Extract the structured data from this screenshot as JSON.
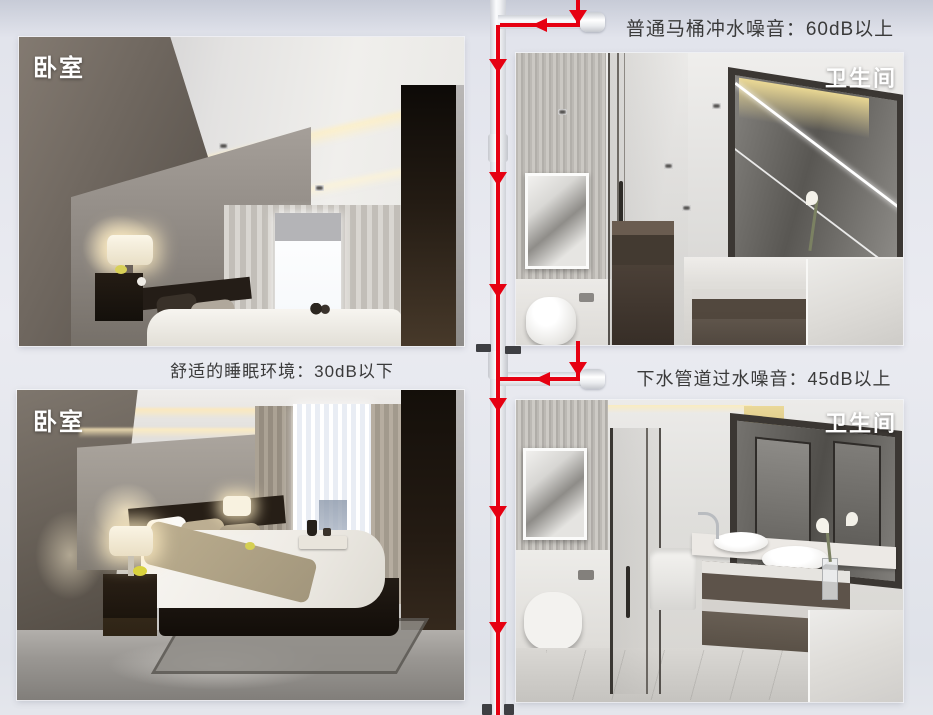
{
  "panels": {
    "bedroom_top": {
      "label": "卧室"
    },
    "bathroom_top": {
      "label": "卫生间"
    },
    "bedroom_bottom": {
      "label": "卧室"
    },
    "bathroom_bottom": {
      "label": "卫生间"
    }
  },
  "annotations": {
    "toilet_flush_noise": "普通马桶冲水噪音：60dB以上",
    "sleep_environment": "舒适的睡眠环境：30dB以下",
    "drain_pipe_noise": "下水管道过水噪音：45dB以上"
  },
  "colors": {
    "flow_line_red": "#e60011",
    "pipe_white": "#fafbfd",
    "annotation_text": "#3a3a3a",
    "room_label_text": "#ffffff"
  }
}
